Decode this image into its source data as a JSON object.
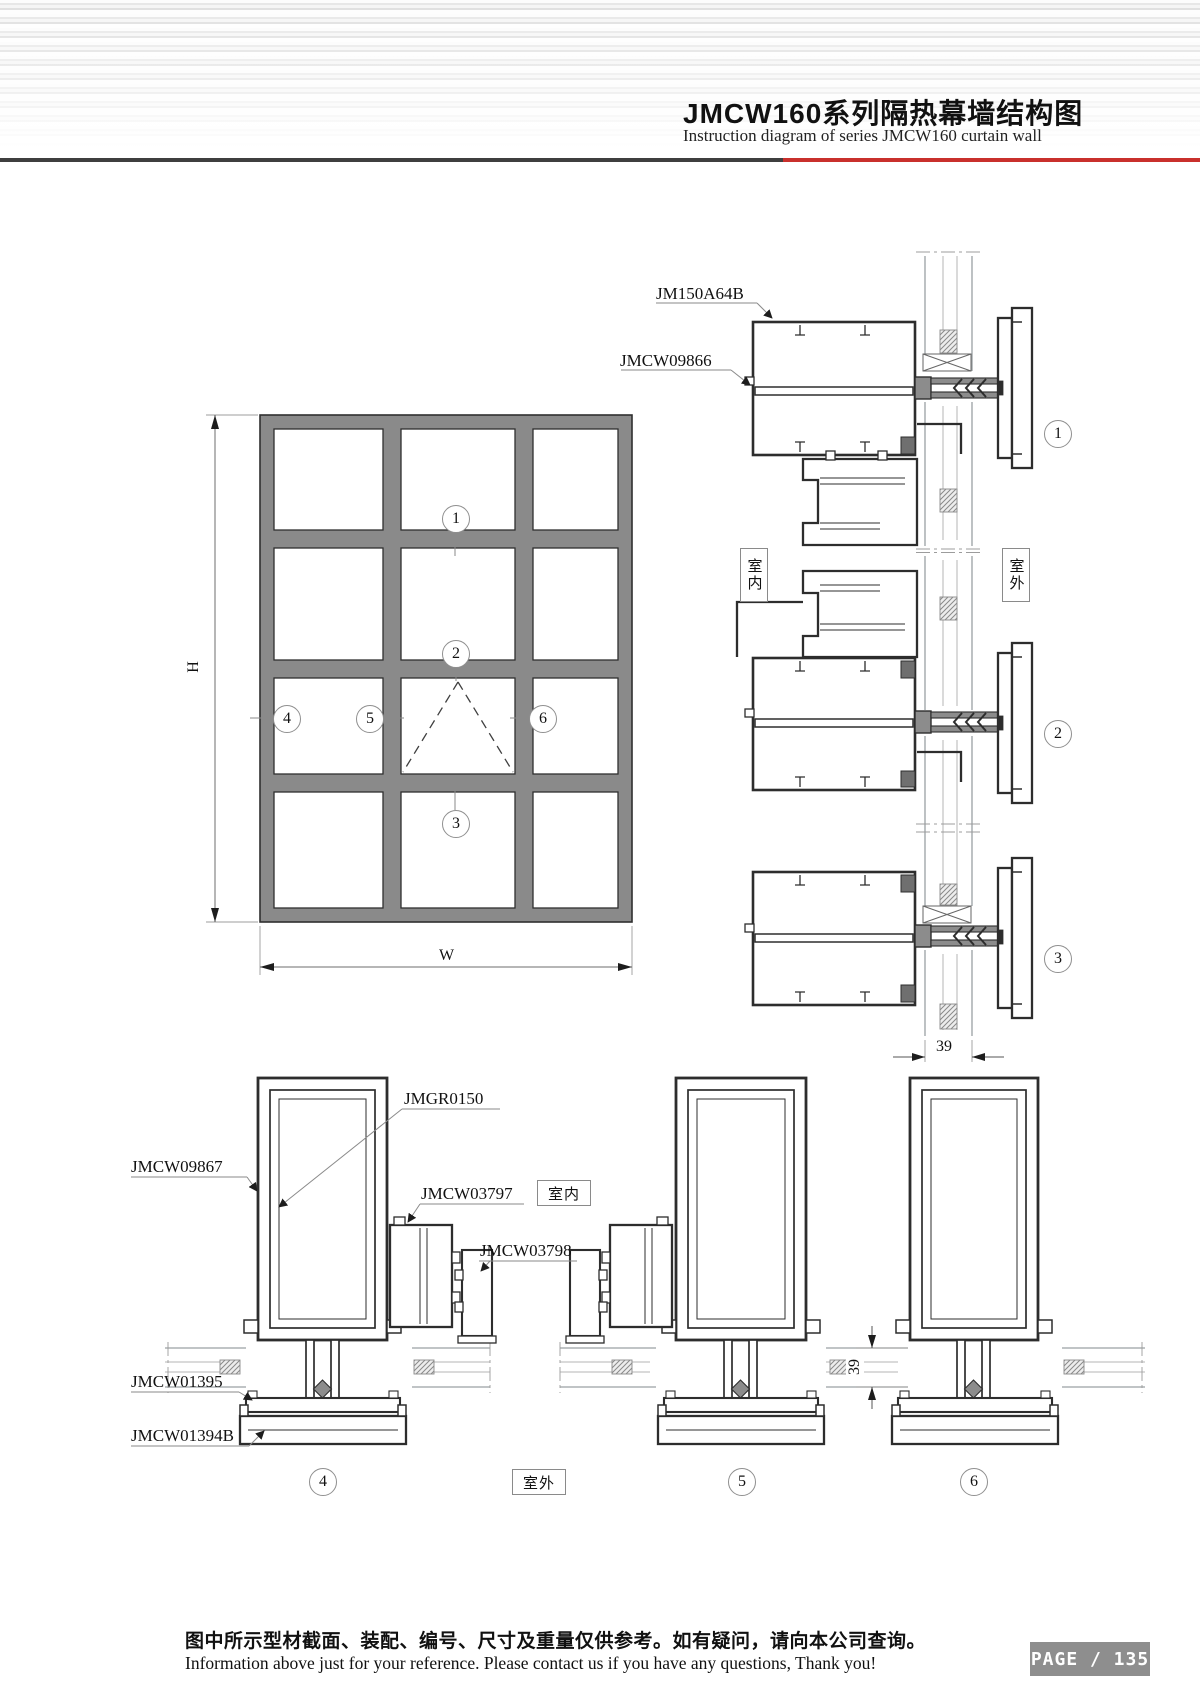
{
  "header": {
    "title": "JMCW160系列隔热幕墙结构图",
    "subtitle": "Instruction diagram of series JMCW160 curtain wall"
  },
  "elevation": {
    "dim_height": "H",
    "dim_width": "W"
  },
  "callouts": {
    "c1": "1",
    "c2": "2",
    "c3": "3",
    "c4": "4",
    "c5": "5",
    "c6": "6"
  },
  "part_labels": {
    "jm150a64b": "JM150A64B",
    "jmcw09866": "JMCW09866",
    "jmgr0150": "JMGR0150",
    "jmcw09867": "JMCW09867",
    "jmcw03797": "JMCW03797",
    "jmcw03798": "JMCW03798",
    "jmcw01395": "JMCW01395",
    "jmcw01394b": "JMCW01394B"
  },
  "annotations": {
    "indoor": "室内",
    "outdoor": "室外",
    "dim_glass": "39"
  },
  "footer": {
    "note_zh": "图中所示型材截面、装配、编号、尺寸及重量仅供参考。如有疑问，请向本公司查询。",
    "note_en": "Information above just for your reference. Please contact us if you have any questions, Thank you!",
    "page_label": "PAGE / 135"
  },
  "colors": {
    "accent_red": "#c9302c",
    "rule_dark": "#3f3f3f",
    "page_badge_bg": "#8e8e8e"
  }
}
